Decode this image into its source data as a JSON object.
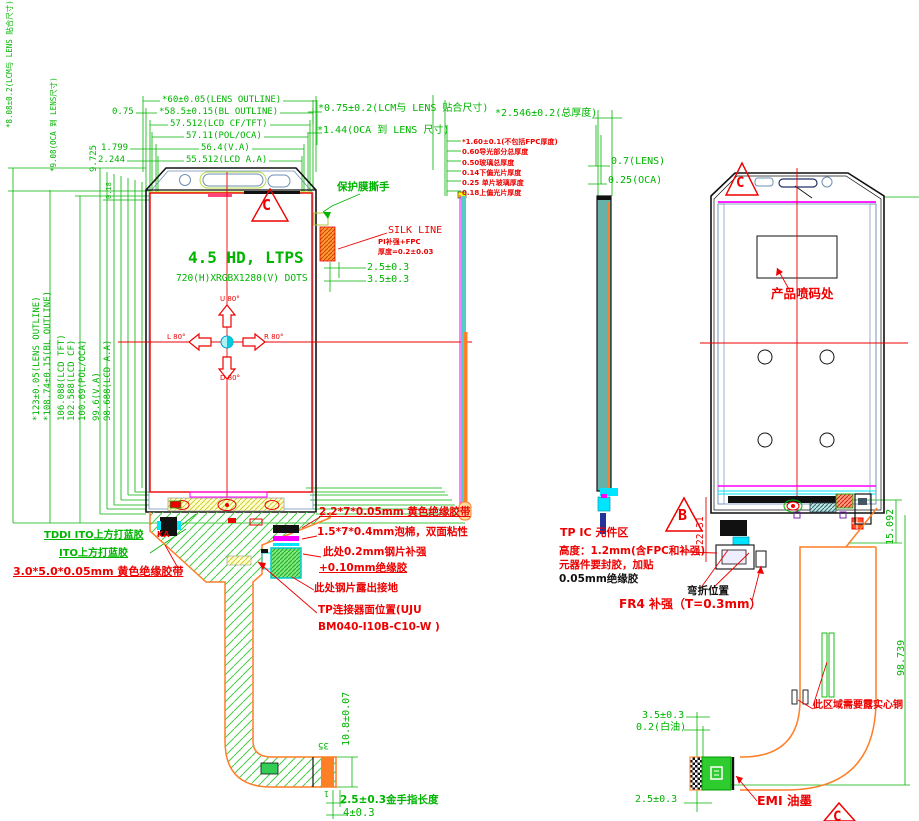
{
  "colors": {
    "cad_green": "#00b400",
    "annotation_red": "#ee0000",
    "magenta": "#ff00ff",
    "cyan": "#00e5ff",
    "orange": "#ff7f27",
    "blue_gray": "#6e8fb5",
    "bright_green": "#2ecc2e",
    "yellow": "#ffff00"
  },
  "left_view": {
    "mark_c": "C",
    "title": "4.5 HD, LTPS",
    "subtitle": "720(H)XRGBX1280(V) DOTS",
    "angle_up": "U 80°",
    "angle_down": "D 80°",
    "angle_left": "L 80°",
    "angle_right": "R 80°",
    "dims_top": [
      "*60±0.05(LENS OUTLINE)",
      "*58.5±0.15(BL OUTLINE)",
      "57.512(LCD CF/TFT)",
      "57.11(POL/OCA)",
      "56.4(V.A)",
      "55.512(LCD A.A)"
    ],
    "dims_top_left": [
      "0.75",
      "1.799",
      "2.244"
    ],
    "dims_far_left": [
      "*8.08±0.2(LCM与 LENS 贴合尺寸)",
      "*9.08(OCA 到 LENS尺寸)",
      "9.725",
      "0.18"
    ],
    "dims_left_vertical": [
      "*123±0.05(LENS OUTLINE)",
      "*108.74±0.15(BL OUTLINE)",
      "106.088(LCD TFT)",
      "102.588(LCD CF)",
      "100.69(POL/OCA)",
      "99.6(V.A)",
      "98.688(LCD A.A)"
    ],
    "lcm_lens": "*0.75±0.2(LCM与 LENS 贴合尺寸)",
    "oca_lens": "*1.44(OCA 到 LENS 尺寸)",
    "protect_film": "保护膜撕手",
    "silk_line": "SILK LINE",
    "silk_pi": "PI补强+FPC",
    "silk_t": "厚度=0.2±0.03",
    "silk_d1": "2.5±0.3",
    "silk_d2": "3.5±0.3",
    "blue_glue_1": "TDDI ITO上方打蓝胶",
    "blue_glue_2": "ITO上方打蓝胶",
    "yellow_tape_3": "3.0*5.0*0.05mm 黄色绝缘胶带",
    "ka": "KA",
    "yellow_tape_2": "2.2*7*0.05mm 黄色绝缘胶带",
    "foam": "1.5*7*0.4mm泡棉，双面粘性",
    "steel_1": "此处0.2mm钢片补强",
    "steel_2": "+0.10mm绝缘胶",
    "ground": "此处钢片露出接地",
    "connector_1": "TP连接器面位置(UJU",
    "connector_2": "BM040-I10B-C10-W )",
    "flex_h": "10.8±0.07",
    "pins": "35",
    "pin1": "1",
    "gold_finger": "2.5±0.3金手指长度",
    "gold_w": "4±0.3"
  },
  "side_view": {
    "total": "*2.546±0.2(总厚度)",
    "stack": [
      "*1.60±0.1(不包括FPC厚度)",
      "0.60导光部分总厚度",
      "0.50玻璃总厚度",
      "0.14下偏光片厚度",
      "0.25 单片玻璃厚度",
      "0.18上偏光片厚度"
    ],
    "lens": "0.7(LENS)",
    "oca": "0.25(OCA)"
  },
  "right_view": {
    "mark_c": "C",
    "mark_b": "B",
    "mark_c2": "C",
    "spray": "产品喷码处",
    "tp_ic_1": "TP IC 元件区",
    "tp_ic_2": "高度：1.2mm(含FPC和补强)",
    "tp_ic_3": "元器件要封胶，加贴",
    "tp_ic_4": "0.05mm绝缘胶",
    "bend": "弯折位置",
    "fr4": "FR4 补强（T=0.3mm）",
    "copper": "此区域需要露实心铜",
    "emi": "EMI 油墨",
    "d_2231": "22.31",
    "d_15092": "15.092",
    "d_98739": "98.739",
    "d_35": "3.5±0.3",
    "white_oil": "0.2(白油)",
    "d_25": "2.5±0.3"
  }
}
